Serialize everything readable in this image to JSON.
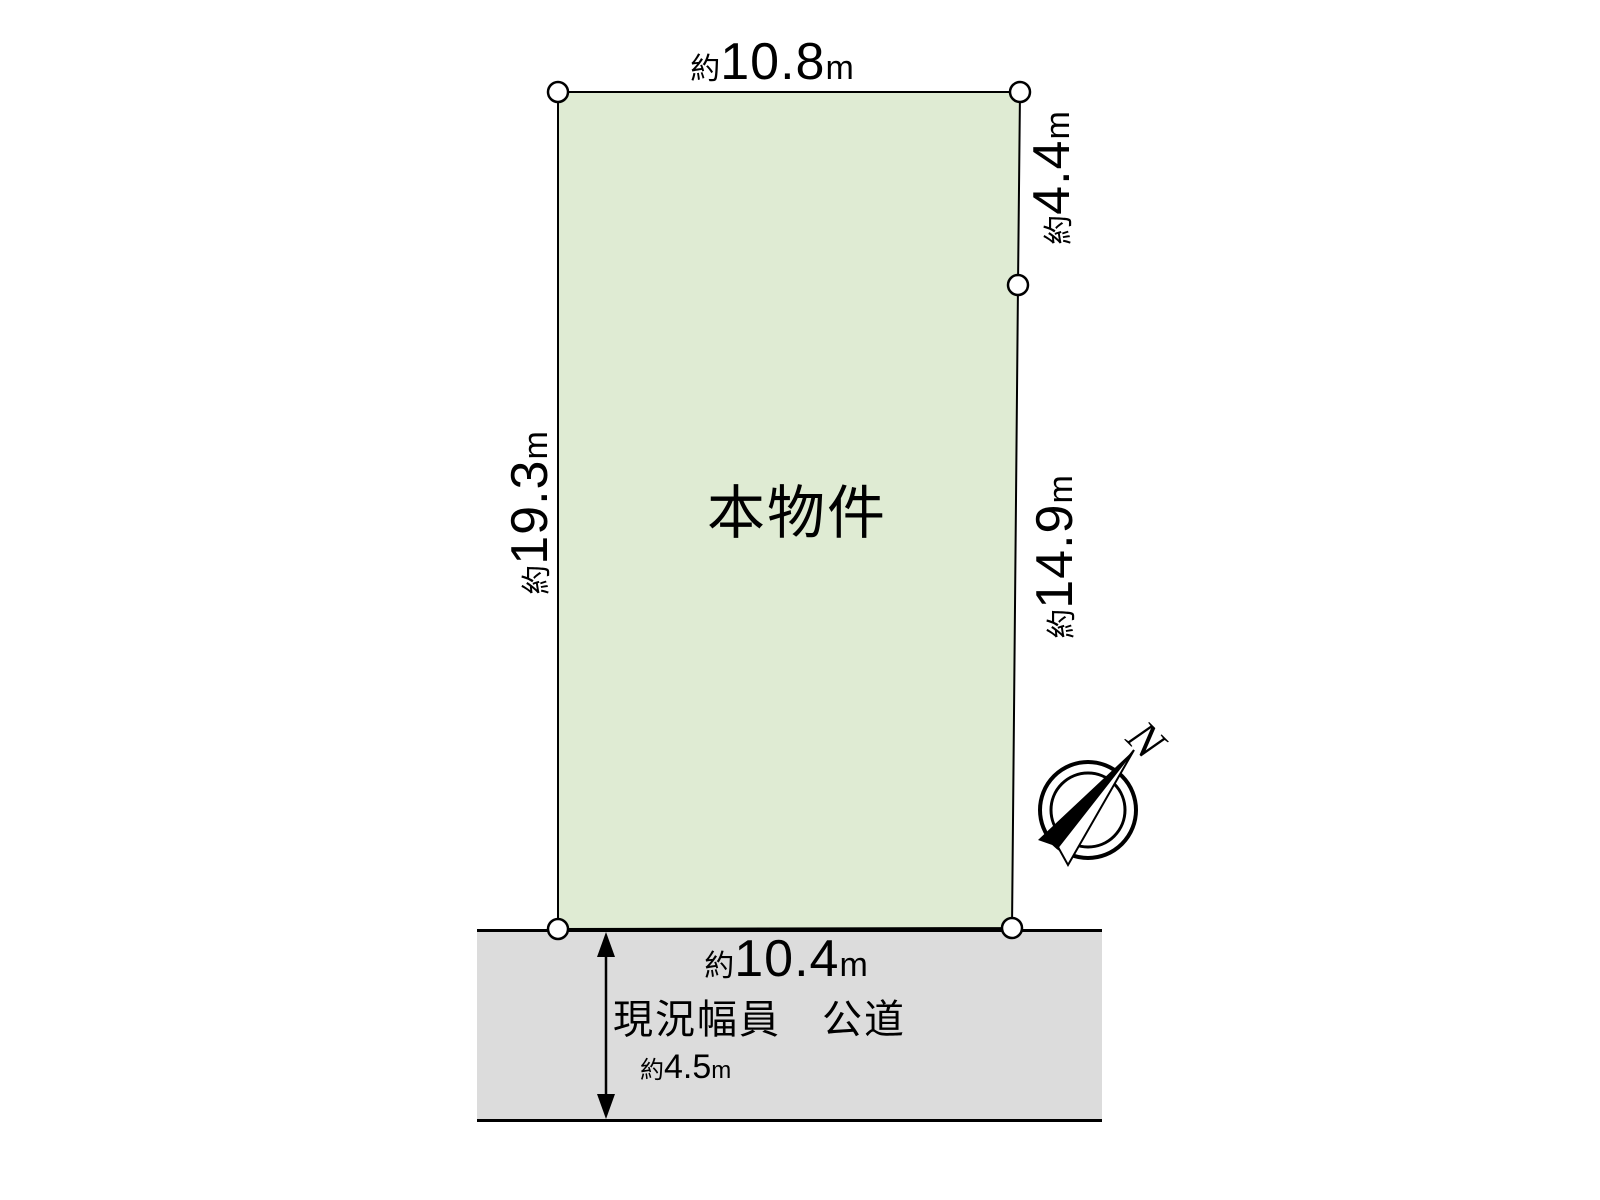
{
  "diagram": {
    "property_label": "本物件",
    "compass_label": "N"
  },
  "colors": {
    "plot_fill": "#dfebd3",
    "road_fill": "#dcdcdc",
    "line": "#000000"
  },
  "dimensions": {
    "top": {
      "prefix": "約",
      "value": "10.8",
      "unit": "m"
    },
    "left": {
      "prefix": "約",
      "value": "19.3",
      "unit": "m"
    },
    "right_upper": {
      "prefix": "約",
      "value": "4.4",
      "unit": "m"
    },
    "right_lower": {
      "prefix": "約",
      "value": "14.9",
      "unit": "m"
    },
    "bottom": {
      "prefix": "約",
      "value": "10.4",
      "unit": "m"
    }
  },
  "road": {
    "current_width_label": "現況幅員",
    "road_type_label": "公道",
    "width": {
      "prefix": "約",
      "value": "4.5",
      "unit": "m"
    }
  }
}
